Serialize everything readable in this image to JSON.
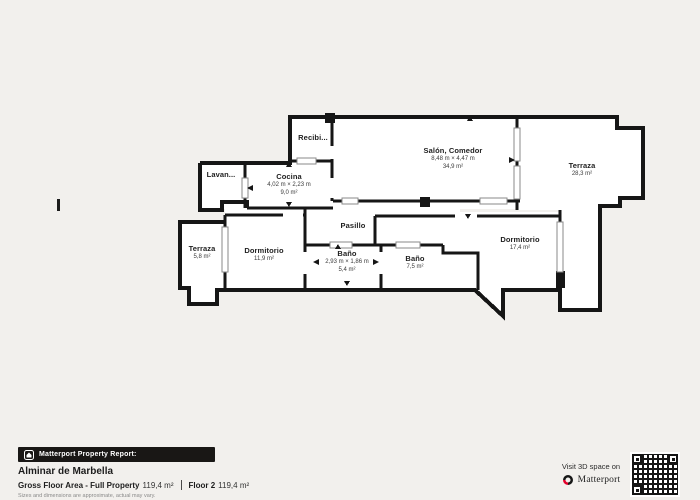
{
  "colors": {
    "wall": "#161616",
    "background": "#f2f0ed",
    "paper": "#ffffff",
    "bar_bg": "#191715",
    "brand_red": "#e4002b"
  },
  "plan": {
    "rooms": [
      {
        "name": "Recibi..."
      },
      {
        "name": "Lavan..."
      },
      {
        "name": "Cocina",
        "dims": "4,02 m × 2,23 m",
        "area": "9,0 m²"
      },
      {
        "name": "Salón, Comedor",
        "dims": "8,48 m × 4,47 m",
        "area": "34,9 m²"
      },
      {
        "name": "Terraza",
        "area": "28,3 m²"
      },
      {
        "name": "Pasillo"
      },
      {
        "name": "Terraza",
        "area": "5,8 m²"
      },
      {
        "name": "Dormitorio",
        "area": "11,9 m²"
      },
      {
        "name": "Baño",
        "dims": "2,93 m × 1,86 m",
        "area": "5,4 m²"
      },
      {
        "name": "Baño",
        "area": "7,5 m²"
      },
      {
        "name": "Dormitorio",
        "area": "17,4 m²"
      }
    ]
  },
  "footer": {
    "report_label": "Matterport Property Report:",
    "property_name": "Alminar de Marbella",
    "gross_label": "Gross Floor Area - Full Property",
    "gross_value": "119,4 m²",
    "floor_label": "Floor 2",
    "floor_value": "119,4 m²",
    "disclaimer": "Sizes and dimensions are approximate, actual may vary.",
    "visit_text": "Visit 3D space on",
    "brand": "Matterport"
  }
}
